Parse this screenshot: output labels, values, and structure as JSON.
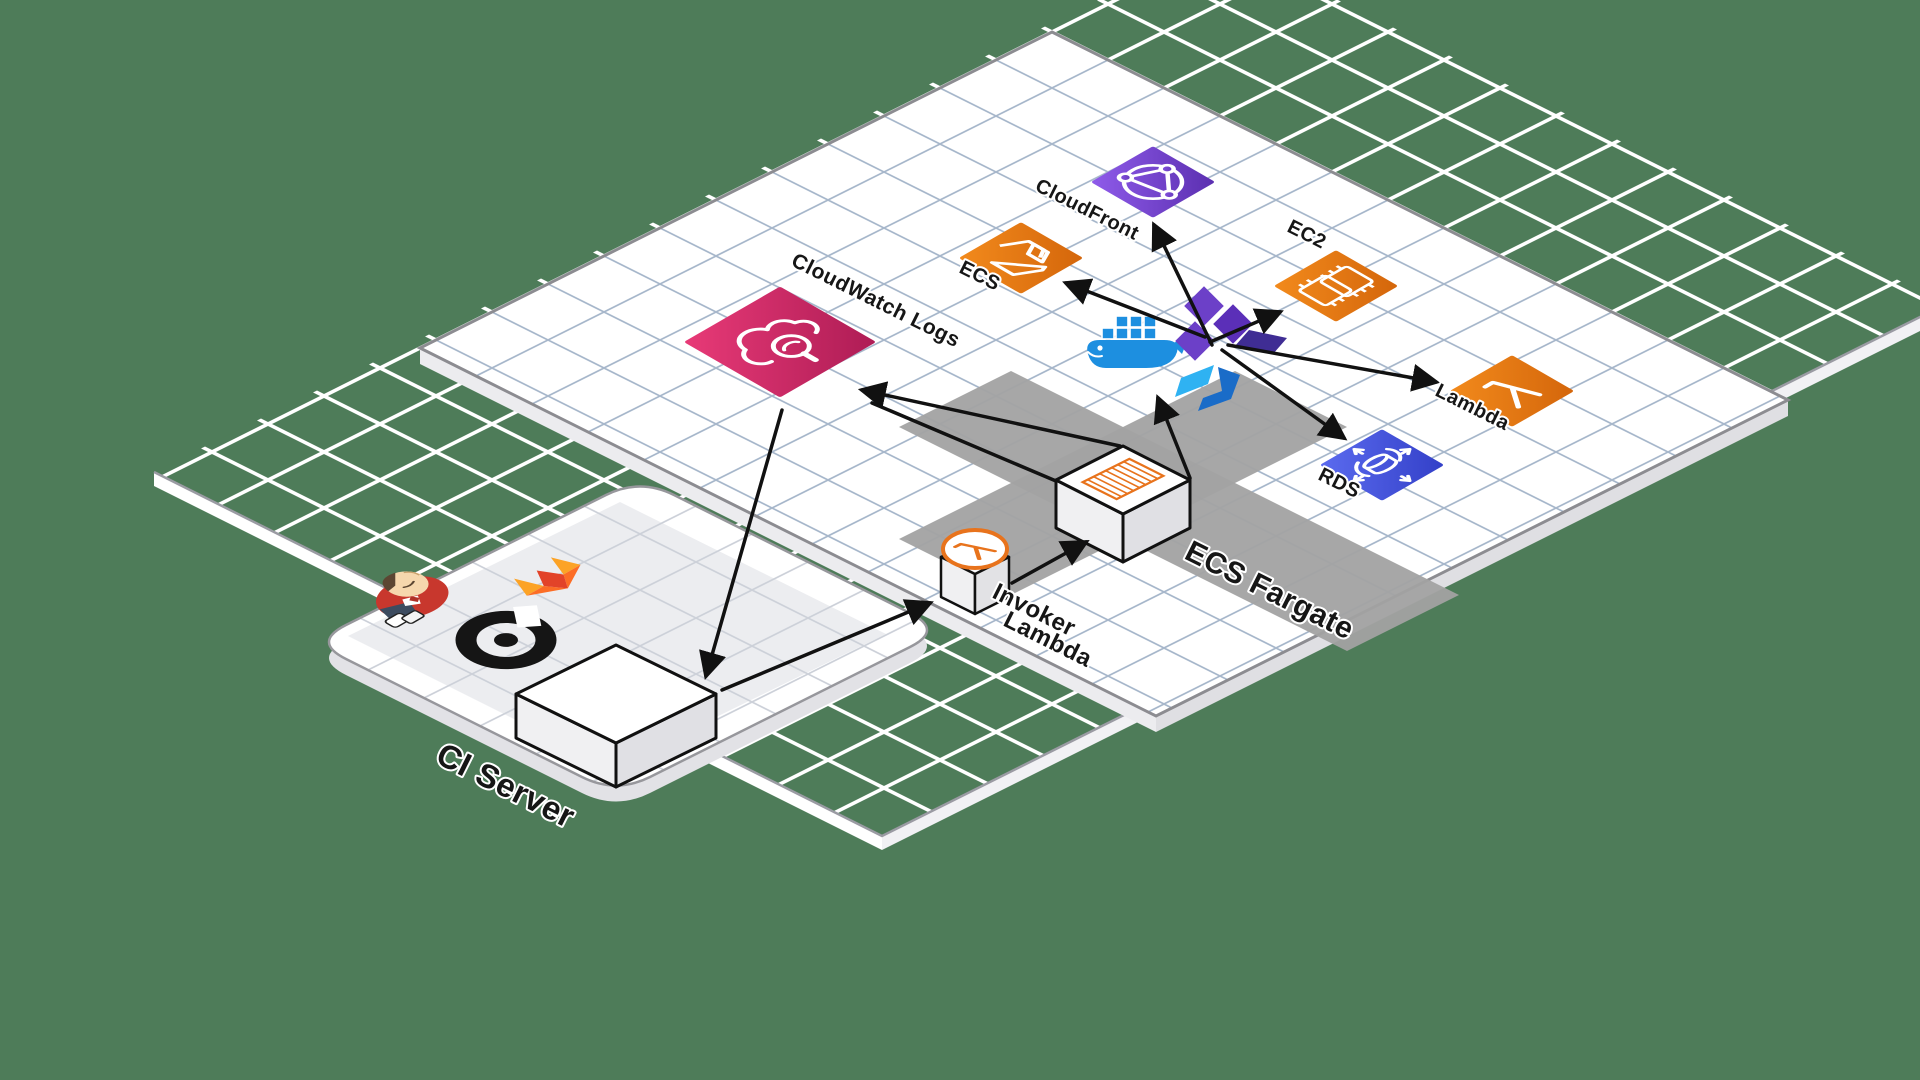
{
  "diagram": {
    "title": "CI/CD isometric architecture diagram",
    "background_color": "#4E7C59",
    "grid": {
      "major_line_color": "#FFFFFF",
      "minor_line_color": "#6F7AA8",
      "platform_line_color": "#A7B7CB"
    },
    "platforms": {
      "ci": {
        "label": "CI Server"
      },
      "main": {
        "label": ""
      }
    },
    "zones": {
      "ecs_fargate": {
        "label": "ECS Fargate",
        "color": "#A2A2A2"
      }
    },
    "nodes": {
      "cloudfront": {
        "label": "CloudFront",
        "icon": "cloudfront-globe-icon",
        "color": "#7C4DDC"
      },
      "ecs": {
        "label": "ECS",
        "icon": "ecs-container-icon",
        "color": "#E87A16"
      },
      "ec2": {
        "label": "EC2",
        "icon": "ec2-chip-icon",
        "color": "#E87A16"
      },
      "lambda": {
        "label": "Lambda",
        "icon": "lambda-icon",
        "color": "#E87A16"
      },
      "rds": {
        "label": "RDS",
        "icon": "rds-database-icon",
        "color": "#4150D8"
      },
      "cloudwatch_logs": {
        "label": "CloudWatch Logs",
        "icon": "cloudwatch-logs-icon",
        "color": "#D42A66"
      },
      "invoker_lambda": {
        "label_line1": "Invoker",
        "label_line2": "Lambda",
        "icon": "lambda-circle-icon"
      },
      "fargate_task": {
        "label": "",
        "icon": "container-image-icon"
      },
      "ci_server_box": {
        "label": ""
      }
    },
    "tools": [
      "jenkins-mascot",
      "gitlab-logo",
      "circleci-logo",
      "docker-whale",
      "terraform-logo",
      "packer-logo"
    ],
    "edges": [
      {
        "from": "cloudwatch_logs",
        "to": "ci_server_box"
      },
      {
        "from": "ci_server_box",
        "to": "invoker_lambda"
      },
      {
        "from": "invoker_lambda",
        "to": "fargate_task"
      },
      {
        "from": "fargate_task",
        "to": "cloudwatch_logs"
      },
      {
        "from": "fargate_task",
        "to": "deploy_tools"
      },
      {
        "from": "deploy_tools",
        "to": "cloudfront"
      },
      {
        "from": "deploy_tools",
        "to": "ecs"
      },
      {
        "from": "deploy_tools",
        "to": "ec2"
      },
      {
        "from": "deploy_tools",
        "to": "lambda"
      },
      {
        "from": "deploy_tools",
        "to": "rds"
      }
    ],
    "arrow_color": "#111111"
  }
}
